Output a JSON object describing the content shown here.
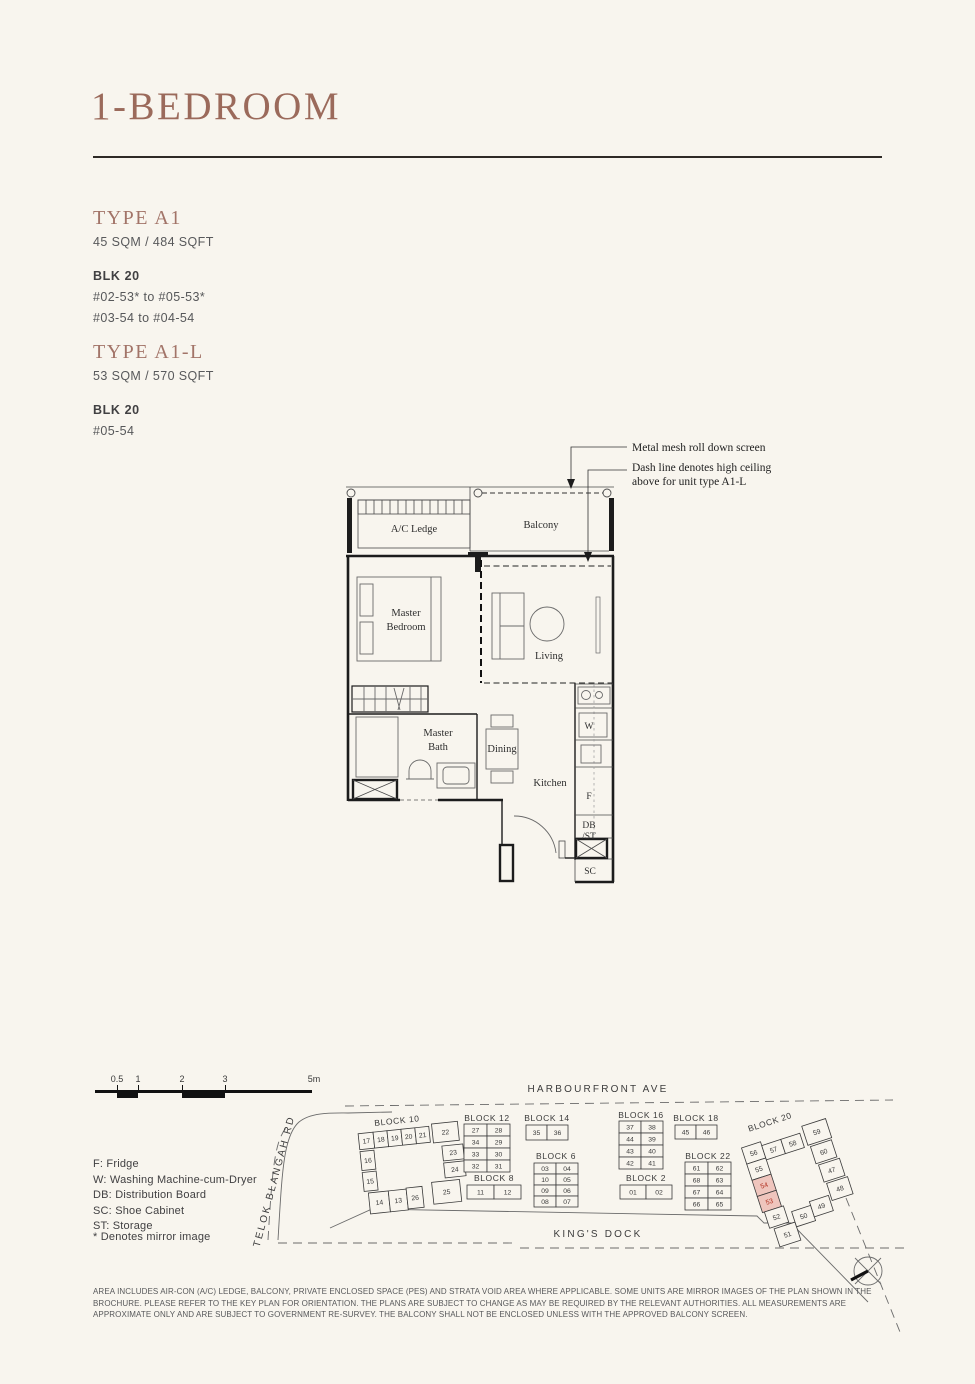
{
  "header": {
    "title": "1-BEDROOM"
  },
  "types": [
    {
      "name": "TYPE A1",
      "area": "45 SQM / 484 SQFT",
      "blk": "BLK 20",
      "units": [
        "#02-53* to #05-53*",
        "#03-54 to #04-54"
      ]
    },
    {
      "name": "TYPE A1-L",
      "area": "53 SQM / 570 SQFT",
      "blk": "BLK 20",
      "units": [
        "#05-54"
      ]
    }
  ],
  "floorplan": {
    "annotations": {
      "mesh": "Metal mesh roll down screen",
      "dash1": "Dash line denotes high ceiling",
      "dash2": "above for unit type A1-L"
    },
    "labels": {
      "ac_ledge": "A/C Ledge",
      "balcony": "Balcony",
      "master_bedroom_line1": "Master",
      "master_bedroom_line2": "Bedroom",
      "living": "Living",
      "master_bath_line1": "Master",
      "master_bath_line2": "Bath",
      "dining": "Dining",
      "kitchen": "Kitchen",
      "washer": "W",
      "fridge": "F",
      "db": "DB",
      "st": "/ST",
      "sc": "SC"
    }
  },
  "scalebar": {
    "labels": [
      "0.5",
      "1",
      "2",
      "3",
      "5m"
    ]
  },
  "legend": {
    "items": [
      "F: Fridge",
      "W: Washing Machine-cum-Dryer",
      "DB: Distribution Board",
      "SC: Shoe Cabinet",
      "ST: Storage"
    ],
    "mirror_note": "* Denotes mirror image"
  },
  "keyplan": {
    "roads": {
      "top": "HARBOURFRONT AVE",
      "left": "TELOK BLANGAH RD",
      "bottom": "KING'S DOCK"
    },
    "highlighted_units": [
      "54",
      "53"
    ],
    "blocks": [
      {
        "label": "BLOCK 10",
        "lx": 402,
        "ly": 1122,
        "rot": [
          -6,
          415,
          1168
        ],
        "cells": [
          {
            "n": "17",
            "x": 362,
            "y": 1128,
            "w": 15,
            "h": 16
          },
          {
            "n": "18",
            "x": 377,
            "y": 1128,
            "w": 14,
            "h": 16
          },
          {
            "n": "19",
            "x": 391,
            "y": 1128,
            "w": 14,
            "h": 16
          },
          {
            "n": "20",
            "x": 405,
            "y": 1128,
            "w": 14,
            "h": 16
          },
          {
            "n": "21",
            "x": 419,
            "y": 1128,
            "w": 14,
            "h": 16
          },
          {
            "n": "22",
            "x": 436,
            "y": 1126,
            "w": 26,
            "h": 19
          },
          {
            "n": "16",
            "x": 362,
            "y": 1146,
            "w": 14,
            "h": 19
          },
          {
            "n": "15",
            "x": 362,
            "y": 1167,
            "w": 14,
            "h": 19
          },
          {
            "n": "23",
            "x": 444,
            "y": 1149,
            "w": 21,
            "h": 15
          },
          {
            "n": "24",
            "x": 444,
            "y": 1166,
            "w": 21,
            "h": 15
          },
          {
            "n": "14",
            "x": 366,
            "y": 1188,
            "w": 20,
            "h": 21
          },
          {
            "n": "13",
            "x": 386,
            "y": 1188,
            "w": 18,
            "h": 21
          },
          {
            "n": "26",
            "x": 404,
            "y": 1187,
            "w": 16,
            "h": 21
          },
          {
            "n": "25",
            "x": 430,
            "y": 1184,
            "w": 28,
            "h": 22
          }
        ]
      },
      {
        "label": "BLOCK 12",
        "lx": 487,
        "ly": 1121,
        "cells": [
          {
            "n": "27",
            "x": 464,
            "y": 1124,
            "w": 23,
            "h": 12
          },
          {
            "n": "28",
            "x": 487,
            "y": 1124,
            "w": 23,
            "h": 12
          },
          {
            "n": "34",
            "x": 464,
            "y": 1136,
            "w": 23,
            "h": 12
          },
          {
            "n": "29",
            "x": 487,
            "y": 1136,
            "w": 23,
            "h": 12
          },
          {
            "n": "33",
            "x": 464,
            "y": 1148,
            "w": 23,
            "h": 12
          },
          {
            "n": "30",
            "x": 487,
            "y": 1148,
            "w": 23,
            "h": 12
          },
          {
            "n": "32",
            "x": 464,
            "y": 1160,
            "w": 23,
            "h": 12
          },
          {
            "n": "31",
            "x": 487,
            "y": 1160,
            "w": 23,
            "h": 12
          }
        ]
      },
      {
        "label": "BLOCK 14",
        "lx": 547,
        "ly": 1121,
        "cells": [
          {
            "n": "35",
            "x": 526,
            "y": 1125,
            "w": 21,
            "h": 15
          },
          {
            "n": "36",
            "x": 547,
            "y": 1125,
            "w": 21,
            "h": 15
          }
        ]
      },
      {
        "label": "BLOCK 8",
        "lx": 494,
        "ly": 1181,
        "cells": [
          {
            "n": "11",
            "x": 467,
            "y": 1185,
            "w": 27,
            "h": 14
          },
          {
            "n": "12",
            "x": 494,
            "y": 1185,
            "w": 27,
            "h": 14
          }
        ]
      },
      {
        "label": "BLOCK 6",
        "lx": 556,
        "ly": 1159,
        "cells": [
          {
            "n": "03",
            "x": 534,
            "y": 1163,
            "w": 22,
            "h": 11
          },
          {
            "n": "04",
            "x": 556,
            "y": 1163,
            "w": 22,
            "h": 11
          },
          {
            "n": "10",
            "x": 534,
            "y": 1174,
            "w": 22,
            "h": 11
          },
          {
            "n": "05",
            "x": 556,
            "y": 1174,
            "w": 22,
            "h": 11
          },
          {
            "n": "09",
            "x": 534,
            "y": 1185,
            "w": 22,
            "h": 11
          },
          {
            "n": "06",
            "x": 556,
            "y": 1185,
            "w": 22,
            "h": 11
          },
          {
            "n": "08",
            "x": 534,
            "y": 1196,
            "w": 22,
            "h": 11
          },
          {
            "n": "07",
            "x": 556,
            "y": 1196,
            "w": 22,
            "h": 11
          }
        ]
      },
      {
        "label": "BLOCK 16",
        "lx": 641,
        "ly": 1118,
        "cells": [
          {
            "n": "37",
            "x": 619,
            "y": 1121,
            "w": 22,
            "h": 12
          },
          {
            "n": "38",
            "x": 641,
            "y": 1121,
            "w": 22,
            "h": 12
          },
          {
            "n": "44",
            "x": 619,
            "y": 1133,
            "w": 22,
            "h": 12
          },
          {
            "n": "39",
            "x": 641,
            "y": 1133,
            "w": 22,
            "h": 12
          },
          {
            "n": "43",
            "x": 619,
            "y": 1145,
            "w": 22,
            "h": 12
          },
          {
            "n": "40",
            "x": 641,
            "y": 1145,
            "w": 22,
            "h": 12
          },
          {
            "n": "42",
            "x": 619,
            "y": 1157,
            "w": 22,
            "h": 12
          },
          {
            "n": "41",
            "x": 641,
            "y": 1157,
            "w": 22,
            "h": 12
          }
        ]
      },
      {
        "label": "BLOCK 18",
        "lx": 696,
        "ly": 1121,
        "cells": [
          {
            "n": "45",
            "x": 675,
            "y": 1125,
            "w": 21,
            "h": 14
          },
          {
            "n": "46",
            "x": 696,
            "y": 1125,
            "w": 21,
            "h": 14
          }
        ]
      },
      {
        "label": "BLOCK 2",
        "lx": 646,
        "ly": 1181,
        "cells": [
          {
            "n": "01",
            "x": 620,
            "y": 1185,
            "w": 26,
            "h": 14
          },
          {
            "n": "02",
            "x": 646,
            "y": 1185,
            "w": 26,
            "h": 14
          }
        ]
      },
      {
        "label": "BLOCK 22",
        "lx": 708,
        "ly": 1159,
        "cells": [
          {
            "n": "61",
            "x": 685,
            "y": 1162,
            "w": 23,
            "h": 12
          },
          {
            "n": "62",
            "x": 708,
            "y": 1162,
            "w": 23,
            "h": 12
          },
          {
            "n": "68",
            "x": 685,
            "y": 1174,
            "w": 23,
            "h": 12
          },
          {
            "n": "63",
            "x": 708,
            "y": 1174,
            "w": 23,
            "h": 12
          },
          {
            "n": "67",
            "x": 685,
            "y": 1186,
            "w": 23,
            "h": 12
          },
          {
            "n": "64",
            "x": 708,
            "y": 1186,
            "w": 23,
            "h": 12
          },
          {
            "n": "66",
            "x": 685,
            "y": 1198,
            "w": 23,
            "h": 12
          },
          {
            "n": "65",
            "x": 708,
            "y": 1198,
            "w": 23,
            "h": 12
          }
        ]
      },
      {
        "label": "BLOCK 20",
        "lx": 789,
        "ly": 1120,
        "rot": [
          -18,
          795,
          1180
        ],
        "cells": [
          {
            "n": "56",
            "x": 754,
            "y": 1133,
            "w": 20,
            "h": 17
          },
          {
            "n": "55",
            "x": 754,
            "y": 1150,
            "w": 20,
            "h": 17
          },
          {
            "n": "54",
            "x": 754,
            "y": 1167,
            "w": 20,
            "h": 17,
            "hl": true
          },
          {
            "n": "53",
            "x": 754,
            "y": 1184,
            "w": 20,
            "h": 17,
            "hl": true
          },
          {
            "n": "52",
            "x": 756,
            "y": 1201,
            "w": 20,
            "h": 17
          },
          {
            "n": "51",
            "x": 760,
            "y": 1220,
            "w": 22,
            "h": 19
          },
          {
            "n": "57",
            "x": 774,
            "y": 1137,
            "w": 20,
            "h": 15
          },
          {
            "n": "58",
            "x": 794,
            "y": 1137,
            "w": 20,
            "h": 15
          },
          {
            "n": "59",
            "x": 818,
            "y": 1131,
            "w": 25,
            "h": 20
          },
          {
            "n": "60",
            "x": 820,
            "y": 1153,
            "w": 22,
            "h": 18
          },
          {
            "n": "47",
            "x": 822,
            "y": 1173,
            "w": 22,
            "h": 18
          },
          {
            "n": "48",
            "x": 824,
            "y": 1193,
            "w": 22,
            "h": 18
          },
          {
            "n": "50",
            "x": 782,
            "y": 1209,
            "w": 20,
            "h": 16
          },
          {
            "n": "49",
            "x": 802,
            "y": 1205,
            "w": 20,
            "h": 16
          }
        ]
      }
    ]
  },
  "disclaimer": "AREA INCLUDES AIR-CON (A/C) LEDGE, BALCONY, PRIVATE ENCLOSED SPACE (PES) AND STRATA VOID AREA WHERE APPLICABLE. SOME UNITS ARE MIRROR IMAGES OF THE PLAN SHOWN IN THE BROCHURE. PLEASE REFER TO THE KEY PLAN FOR ORIENTATION. THE PLANS ARE SUBJECT TO CHANGE AS MAY BE REQUIRED BY THE RELEVANT AUTHORITIES. ALL MEASUREMENTS ARE APPROXIMATE ONLY AND ARE SUBJECT TO GOVERNMENT RE-SURVEY. THE BALCONY SHALL NOT BE ENCLOSED UNLESS WITH THE APPROVED BALCONY SCREEN.",
  "colors": {
    "accent_brown": "#9b6a5b",
    "highlight_fill": "#efc5bd",
    "highlight_text": "#b23222",
    "paper": "#f8f5ee"
  }
}
